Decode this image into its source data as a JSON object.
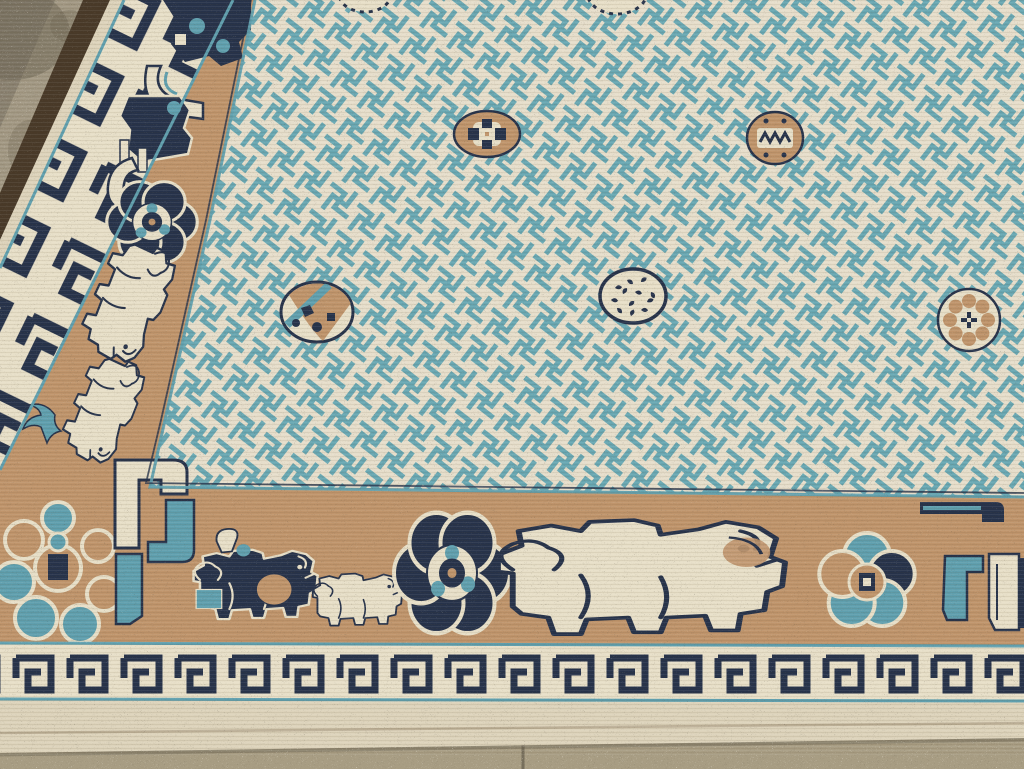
{
  "meta": {
    "subject": "Antique Chinese Peking carpet corner on a concrete floor",
    "alt": "Corner detail of an antique light-blue Chinese carpet with a swastika-fret lattice field, scattered coin medallions, a tan border of fu-dog lions and peony rosettes, ivory key-fret guard borders with teal pinstripes, resting on mottled gray concrete."
  },
  "palette": {
    "ivory": "#e7dfc8",
    "ivory_dim": "#ddd3bb",
    "navy": "#26324a",
    "teal": "#5f9fae",
    "tan": "#bf946b",
    "brown_edge": "#483928",
    "field_teal": "#68a7b2",
    "field_ivory": "#e6decb",
    "floor": "#8a8170",
    "floor_light": "#aaa08a",
    "floor_dark": "#6c6453",
    "floor_bottom": "#a89d83",
    "crease": "#b3a58c"
  },
  "floor": {
    "kind": "mottled concrete slab",
    "visible_areas": [
      "top-left triangle",
      "strip below rug bottom edge"
    ]
  },
  "rug": {
    "field_pattern": "sayagata swastika-fret lattice, teal on ivory",
    "guard_border": "navy key-fret meander on ivory with teal pinstripes",
    "main_border": "tan ground with fu-dog lions, hooks and flower rosettes",
    "edge": "dark brown selvedge band and plain ivory flat-woven ends"
  },
  "field": {
    "medallions": [
      {
        "kind": "tan rosette coin",
        "transform": "translate(487,134)"
      },
      {
        "kind": "tan zigzag coin",
        "transform": "translate(775,138)"
      },
      {
        "kind": "half tan / half ivory coin",
        "transform": "translate(317,312)"
      },
      {
        "kind": "ivory seed-pod coin with navy speckles",
        "transform": "translate(633,296)"
      },
      {
        "kind": "ivory coin with tan petals",
        "transform": "translate(969,320)"
      },
      {
        "kind": "partial ivory coin at top edge",
        "transform": "translate(365,-6)"
      },
      {
        "kind": "partial ivory coin at top edge",
        "transform": "translate(617,-8)"
      }
    ]
  },
  "borders": {
    "left": {
      "motifs": [
        {
          "kind": "navy lion fragment with teal curls",
          "transform": "translate(205,40)"
        },
        {
          "kind": "navy lion with ivory tail curl",
          "transform": "translate(158,130)"
        },
        {
          "kind": "small navy peony rosette",
          "transform": "translate(152,222) scale(0.78,0.75)"
        },
        {
          "kind": "ivory walking lion",
          "transform": "translate(128,300) rotate(115) scale(0.62,0.55)"
        },
        {
          "kind": "teal swallow",
          "transform": "translate(55,415)"
        },
        {
          "kind": "ivory walking lion",
          "transform": "translate(103,408) rotate(115) scale(0.55,0.48)"
        }
      ]
    },
    "bottom": {
      "motifs": [
        {
          "kind": "corner flower cluster, teal and tan lobes",
          "transform": "translate(58,568)"
        },
        {
          "kind": "ivory and teal tail hooks",
          "transform": "translate(160,540)"
        },
        {
          "kind": "dark navy lion with tan haunch",
          "transform": "translate(255,585) scale(0.64,0.56)"
        },
        {
          "kind": "small ivory lion cub",
          "transform": "translate(357,600) scale(0.46,0.42)"
        },
        {
          "kind": "navy peony rosette",
          "transform": "translate(452,573) scale(1,1.12)"
        },
        {
          "kind": "large ivory walking lion with tan mane",
          "transform": "translate(640,578) scale(1.48,0.92)"
        },
        {
          "kind": "teal flower rosette with tan center",
          "transform": "translate(867,582)"
        },
        {
          "kind": "navy and teal edge hooks with ivory bar",
          "transform": "translate(975,560)"
        }
      ]
    }
  }
}
